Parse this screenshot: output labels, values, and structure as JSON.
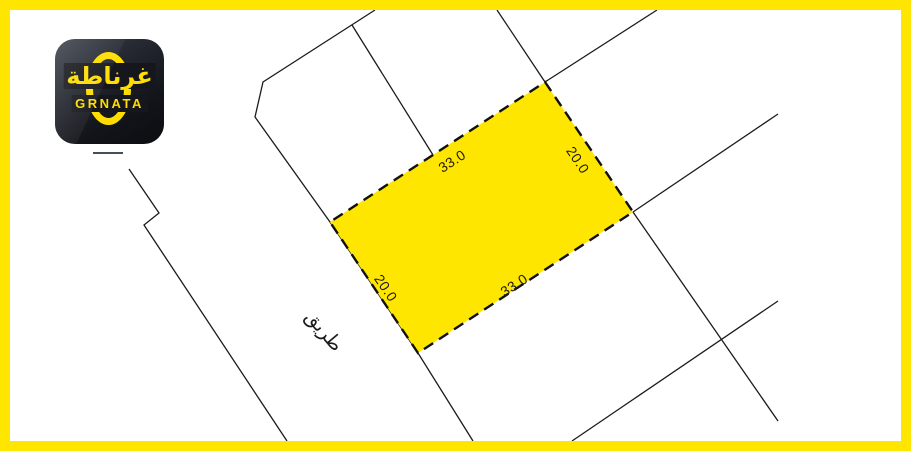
{
  "logo": {
    "arabic": "غرناطة",
    "latin": "GRNATA"
  },
  "plan": {
    "road_label": "طريق",
    "plot_dimensions": {
      "top": "33.0",
      "right": "20.0",
      "bottom": "33.0",
      "left": "20.0"
    }
  },
  "colors": {
    "frame_yellow": "#ffe600",
    "plot_yellow": "#ffe600",
    "line_dark": "#1b1b1b",
    "dash_dark": "#111111",
    "logo_yellow": "#ffdd00",
    "logo_bg": "#15171c",
    "tick_gray": "#42505c"
  }
}
